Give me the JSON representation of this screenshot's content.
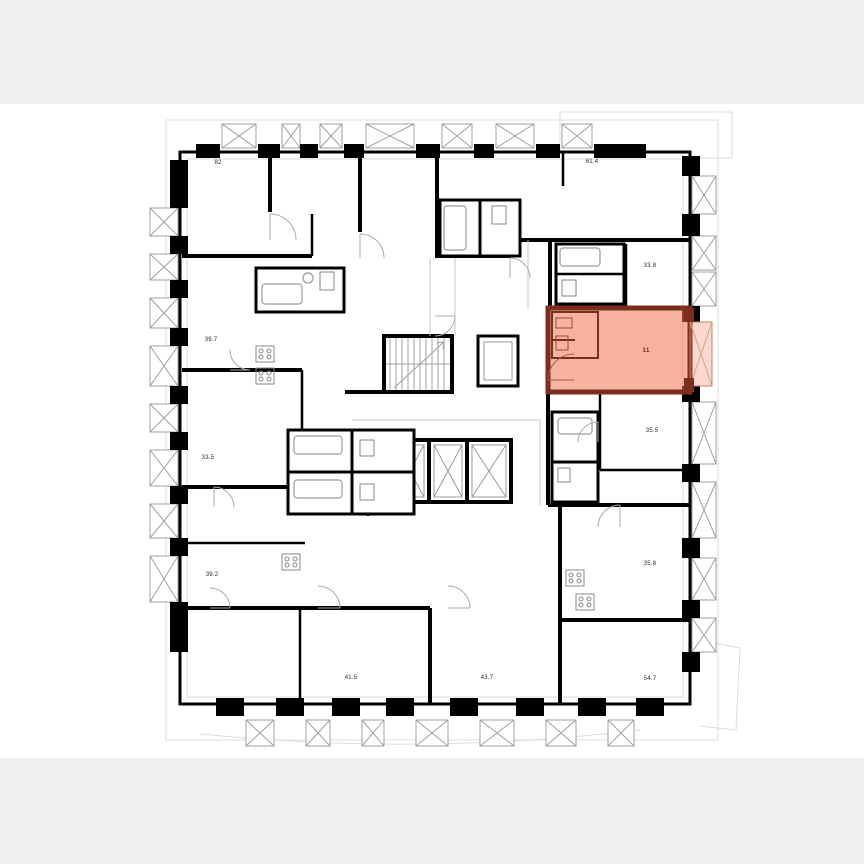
{
  "page": {
    "background_color": "#ffffff",
    "letterbox_color": "#f0f0f0",
    "type_label": "floor-plan"
  },
  "floorplan": {
    "wall_color": "#000000",
    "detail_color": "#999999",
    "contour_color": "#dcdcdc",
    "highlight": {
      "area_label": "11",
      "fill": "rgba(240,115,85,0.55)",
      "border": "#7c2d1b",
      "balcony_fill": "rgba(240,115,85,0.28)"
    },
    "core": {
      "stairwell": "stairs",
      "elevators_count": "4"
    },
    "rooms": [
      {
        "id": "apt-top-left",
        "area": "82"
      },
      {
        "id": "apt-top-right",
        "area": "61.4"
      },
      {
        "id": "apt-right-1",
        "area": "33.8"
      },
      {
        "id": "apt-right-2",
        "area": "35.5"
      },
      {
        "id": "apt-right-3",
        "area": "35.8"
      },
      {
        "id": "apt-bottom-right",
        "area": "54.7"
      },
      {
        "id": "apt-bottom-mid-right",
        "area": "43.7"
      },
      {
        "id": "apt-bottom-mid-left",
        "area": "41.5"
      },
      {
        "id": "apt-left-3",
        "area": "39.2"
      },
      {
        "id": "apt-left-2",
        "area": "33.5"
      },
      {
        "id": "apt-left-1",
        "area": "39.7"
      }
    ]
  }
}
